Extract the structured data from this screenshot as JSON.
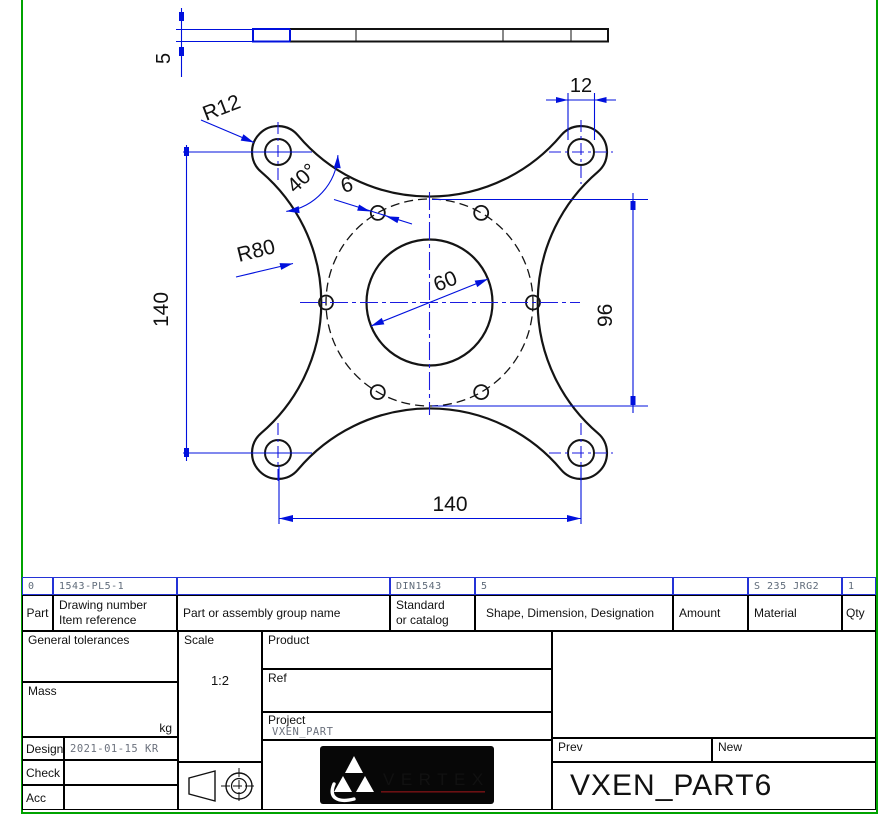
{
  "app": {
    "frame_color": "#00a300",
    "dimension_color": "#0010dd"
  },
  "drawing": {
    "side_view": {
      "thickness_dim": "5"
    },
    "front_view": {
      "dim_hole_diameter": "12",
      "dim_corner_radius": "R12",
      "dim_angle": "40°",
      "dim_small_hole": "6",
      "dim_edge_radius": "R80",
      "dim_center_hole": "60",
      "dim_bolt_circle": "96",
      "dim_width": "140",
      "dim_height": "140"
    }
  },
  "title_block": {
    "item_row": {
      "part_no": "0",
      "drawing_number": "1543-PL5-1",
      "group_name": "",
      "standard": "DIN1543",
      "shape": "5",
      "amount": "",
      "material": "S 235 JRG2",
      "qty": "1"
    },
    "headers": {
      "part": "Part",
      "drawing_number_line1": "Drawing number",
      "drawing_number_line2": "Item reference",
      "group_name": "Part or assembly group name",
      "standard_line1": "Standard",
      "standard_line2": "or catalog",
      "shape": "Shape, Dimension, Designation",
      "amount": "Amount",
      "material": "Material",
      "qty": "Qty"
    },
    "general_tolerances_label": "General tolerances",
    "scale_label": "Scale",
    "scale_value": "1:2",
    "mass_label": "Mass",
    "mass_unit": "kg",
    "product_label": "Product",
    "ref_label": "Ref",
    "project_label": "Project",
    "project_value": "VXEN_PART",
    "design_label": "Design",
    "design_value": "2021-01-15 KR",
    "check_label": "Check",
    "check_value": "",
    "acc_label": "Acc",
    "acc_value": "",
    "prev_label": "Prev",
    "new_label": "New",
    "part_name": "VXEN_PART6",
    "logo_text": "VERTEX"
  }
}
